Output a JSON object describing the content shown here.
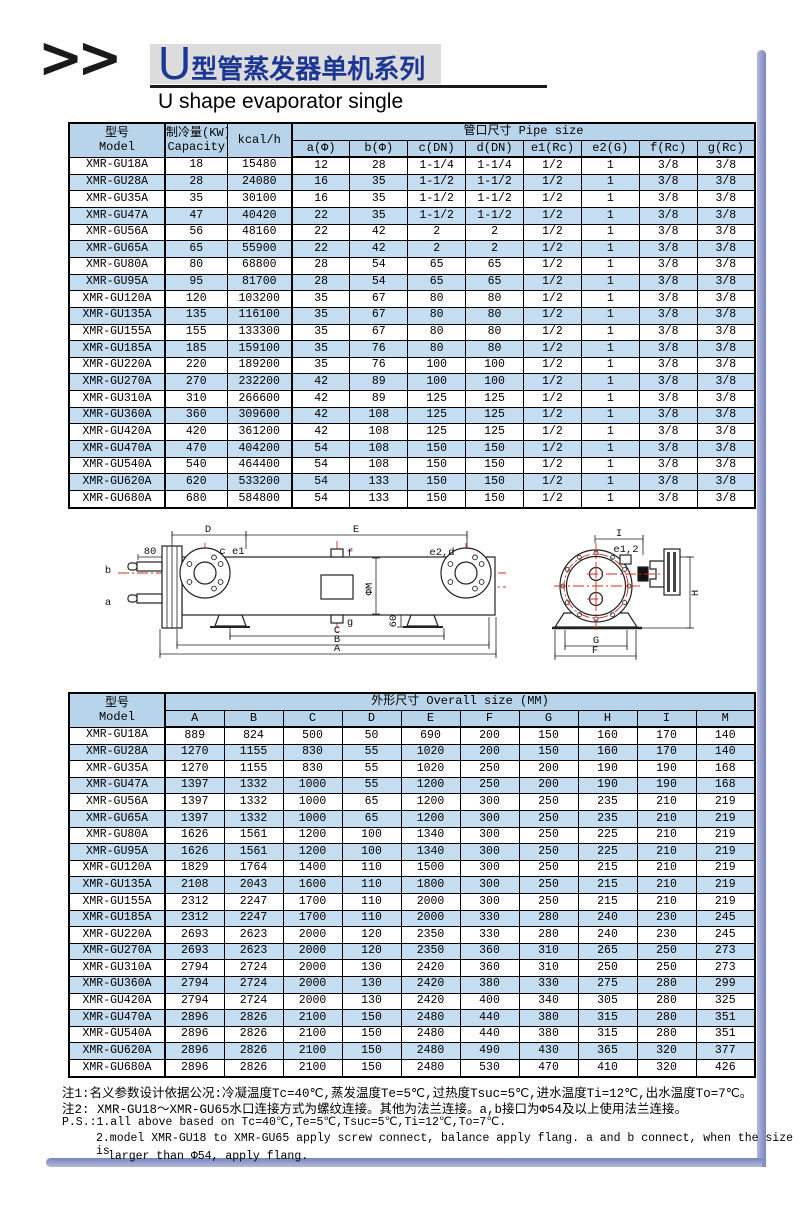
{
  "header": {
    "logo": ">>",
    "title_u": "U",
    "title_rest": "型管蒸发器单机系列",
    "subtitle": "U shape evaporator single"
  },
  "pipe_table": {
    "headers": {
      "model": "型号",
      "model_en": "Model",
      "capacity": "制冷量(KW)",
      "capacity_en": "Capacity",
      "kcal": "kcal/h",
      "group": "管口尺寸 Pipe size",
      "pipe_cols": [
        "a(Φ)",
        "b(Φ)",
        "c(DN)",
        "d(DN)",
        "e1(Rc)",
        "e2(G)",
        "f(Rc)",
        "g(Rc)"
      ]
    },
    "rows": [
      [
        "XMR-GU18A",
        "18",
        "15480",
        "12",
        "28",
        "1-1/4",
        "1-1/4",
        "1/2",
        "1",
        "3/8",
        "3/8"
      ],
      [
        "XMR-GU28A",
        "28",
        "24080",
        "16",
        "35",
        "1-1/2",
        "1-1/2",
        "1/2",
        "1",
        "3/8",
        "3/8"
      ],
      [
        "XMR-GU35A",
        "35",
        "30100",
        "16",
        "35",
        "1-1/2",
        "1-1/2",
        "1/2",
        "1",
        "3/8",
        "3/8"
      ],
      [
        "XMR-GU47A",
        "47",
        "40420",
        "22",
        "35",
        "1-1/2",
        "1-1/2",
        "1/2",
        "1",
        "3/8",
        "3/8"
      ],
      [
        "XMR-GU56A",
        "56",
        "48160",
        "22",
        "42",
        "2",
        "2",
        "1/2",
        "1",
        "3/8",
        "3/8"
      ],
      [
        "XMR-GU65A",
        "65",
        "55900",
        "22",
        "42",
        "2",
        "2",
        "1/2",
        "1",
        "3/8",
        "3/8"
      ],
      [
        "XMR-GU80A",
        "80",
        "68800",
        "28",
        "54",
        "65",
        "65",
        "1/2",
        "1",
        "3/8",
        "3/8"
      ],
      [
        "XMR-GU95A",
        "95",
        "81700",
        "28",
        "54",
        "65",
        "65",
        "1/2",
        "1",
        "3/8",
        "3/8"
      ],
      [
        "XMR-GU120A",
        "120",
        "103200",
        "35",
        "67",
        "80",
        "80",
        "1/2",
        "1",
        "3/8",
        "3/8"
      ],
      [
        "XMR-GU135A",
        "135",
        "116100",
        "35",
        "67",
        "80",
        "80",
        "1/2",
        "1",
        "3/8",
        "3/8"
      ],
      [
        "XMR-GU155A",
        "155",
        "133300",
        "35",
        "67",
        "80",
        "80",
        "1/2",
        "1",
        "3/8",
        "3/8"
      ],
      [
        "XMR-GU185A",
        "185",
        "159100",
        "35",
        "76",
        "80",
        "80",
        "1/2",
        "1",
        "3/8",
        "3/8"
      ],
      [
        "XMR-GU220A",
        "220",
        "189200",
        "35",
        "76",
        "100",
        "100",
        "1/2",
        "1",
        "3/8",
        "3/8"
      ],
      [
        "XMR-GU270A",
        "270",
        "232200",
        "42",
        "89",
        "100",
        "100",
        "1/2",
        "1",
        "3/8",
        "3/8"
      ],
      [
        "XMR-GU310A",
        "310",
        "266600",
        "42",
        "89",
        "125",
        "125",
        "1/2",
        "1",
        "3/8",
        "3/8"
      ],
      [
        "XMR-GU360A",
        "360",
        "309600",
        "42",
        "108",
        "125",
        "125",
        "1/2",
        "1",
        "3/8",
        "3/8"
      ],
      [
        "XMR-GU420A",
        "420",
        "361200",
        "42",
        "108",
        "125",
        "125",
        "1/2",
        "1",
        "3/8",
        "3/8"
      ],
      [
        "XMR-GU470A",
        "470",
        "404200",
        "54",
        "108",
        "150",
        "150",
        "1/2",
        "1",
        "3/8",
        "3/8"
      ],
      [
        "XMR-GU540A",
        "540",
        "464400",
        "54",
        "108",
        "150",
        "150",
        "1/2",
        "1",
        "3/8",
        "3/8"
      ],
      [
        "XMR-GU620A",
        "620",
        "533200",
        "54",
        "133",
        "150",
        "150",
        "1/2",
        "1",
        "3/8",
        "3/8"
      ],
      [
        "XMR-GU680A",
        "680",
        "584800",
        "54",
        "133",
        "150",
        "150",
        "1/2",
        "1",
        "3/8",
        "3/8"
      ]
    ]
  },
  "overall_table": {
    "headers": {
      "model": "型号",
      "model_en": "Model",
      "group": "外形尺寸 Overall size (MM)",
      "cols": [
        "A",
        "B",
        "C",
        "D",
        "E",
        "F",
        "G",
        "H",
        "I",
        "M"
      ]
    },
    "rows": [
      [
        "XMR-GU18A",
        "889",
        "824",
        "500",
        "50",
        "690",
        "200",
        "150",
        "160",
        "170",
        "140"
      ],
      [
        "XMR-GU28A",
        "1270",
        "1155",
        "830",
        "55",
        "1020",
        "200",
        "150",
        "160",
        "170",
        "140"
      ],
      [
        "XMR-GU35A",
        "1270",
        "1155",
        "830",
        "55",
        "1020",
        "250",
        "200",
        "190",
        "190",
        "168"
      ],
      [
        "XMR-GU47A",
        "1397",
        "1332",
        "1000",
        "55",
        "1200",
        "250",
        "200",
        "190",
        "190",
        "168"
      ],
      [
        "XMR-GU56A",
        "1397",
        "1332",
        "1000",
        "65",
        "1200",
        "300",
        "250",
        "235",
        "210",
        "219"
      ],
      [
        "XMR-GU65A",
        "1397",
        "1332",
        "1000",
        "65",
        "1200",
        "300",
        "250",
        "235",
        "210",
        "219"
      ],
      [
        "XMR-GU80A",
        "1626",
        "1561",
        "1200",
        "100",
        "1340",
        "300",
        "250",
        "225",
        "210",
        "219"
      ],
      [
        "XMR-GU95A",
        "1626",
        "1561",
        "1200",
        "100",
        "1340",
        "300",
        "250",
        "225",
        "210",
        "219"
      ],
      [
        "XMR-GU120A",
        "1829",
        "1764",
        "1400",
        "110",
        "1500",
        "300",
        "250",
        "215",
        "210",
        "219"
      ],
      [
        "XMR-GU135A",
        "2108",
        "2043",
        "1600",
        "110",
        "1800",
        "300",
        "250",
        "215",
        "210",
        "219"
      ],
      [
        "XMR-GU155A",
        "2312",
        "2247",
        "1700",
        "110",
        "2000",
        "300",
        "250",
        "215",
        "210",
        "219"
      ],
      [
        "XMR-GU185A",
        "2312",
        "2247",
        "1700",
        "110",
        "2000",
        "330",
        "280",
        "240",
        "230",
        "245"
      ],
      [
        "XMR-GU220A",
        "2693",
        "2623",
        "2000",
        "120",
        "2350",
        "330",
        "280",
        "240",
        "230",
        "245"
      ],
      [
        "XMR-GU270A",
        "2693",
        "2623",
        "2000",
        "120",
        "2350",
        "360",
        "310",
        "265",
        "250",
        "273"
      ],
      [
        "XMR-GU310A",
        "2794",
        "2724",
        "2000",
        "130",
        "2420",
        "360",
        "310",
        "250",
        "250",
        "273"
      ],
      [
        "XMR-GU360A",
        "2794",
        "2724",
        "2000",
        "130",
        "2420",
        "380",
        "330",
        "275",
        "280",
        "299"
      ],
      [
        "XMR-GU420A",
        "2794",
        "2724",
        "2000",
        "130",
        "2420",
        "400",
        "340",
        "305",
        "280",
        "325"
      ],
      [
        "XMR-GU470A",
        "2896",
        "2826",
        "2100",
        "150",
        "2480",
        "440",
        "380",
        "315",
        "280",
        "351"
      ],
      [
        "XMR-GU540A",
        "2896",
        "2826",
        "2100",
        "150",
        "2480",
        "440",
        "380",
        "315",
        "280",
        "351"
      ],
      [
        "XMR-GU620A",
        "2896",
        "2826",
        "2100",
        "150",
        "2480",
        "490",
        "430",
        "365",
        "320",
        "377"
      ],
      [
        "XMR-GU680A",
        "2896",
        "2826",
        "2100",
        "150",
        "2480",
        "530",
        "470",
        "410",
        "320",
        "426"
      ]
    ]
  },
  "diagram": {
    "side": {
      "dim_d": "D",
      "dim_e": "E",
      "dim_80": "80",
      "port_b": "b",
      "port_a": "a",
      "port_f": "f",
      "port_g": "g",
      "label_ce1": "c e1",
      "label_e2d": "e2,d",
      "dim_phi_m": "ΦM",
      "dim_60": "60",
      "dim_c": "C",
      "dim_b": "B",
      "dim_a": "A"
    },
    "end": {
      "dim_i": "I",
      "label_e12": "e1,2",
      "dim_h": "H",
      "dim_g": "G",
      "dim_f": "F"
    }
  },
  "notes": {
    "note1": "注1:名义参数设计依据公况:冷凝温度Tc=40℃,蒸发温度Te=5℃,过热度Tsuc=5℃,进水温度Ti=12℃,出水温度To=7℃。",
    "note2": "注2: XMR-GU18～XMR-GU65水口连接方式为螺纹连接。其他为法兰连接。a,b接口为Φ54及以上使用法兰连接。",
    "ps1": "P.S.:1.all above based on Tc=40℃,Te=5℃,Tsuc=5℃,Ti=12℃,To=7℃.",
    "ps2": "2.model XMR-GU18 to XMR-GU65 apply screw connect, balance apply flang. a and b connect, when the size is",
    "ps3": "larger than Φ54, apply flang."
  },
  "colors": {
    "header_blue": "#b8d4ea",
    "row_alt_blue": "#c5ddf1",
    "title_blue": "#1c3694",
    "frame_blue": "#7a83bd",
    "centerline_red": "#d42a22"
  }
}
